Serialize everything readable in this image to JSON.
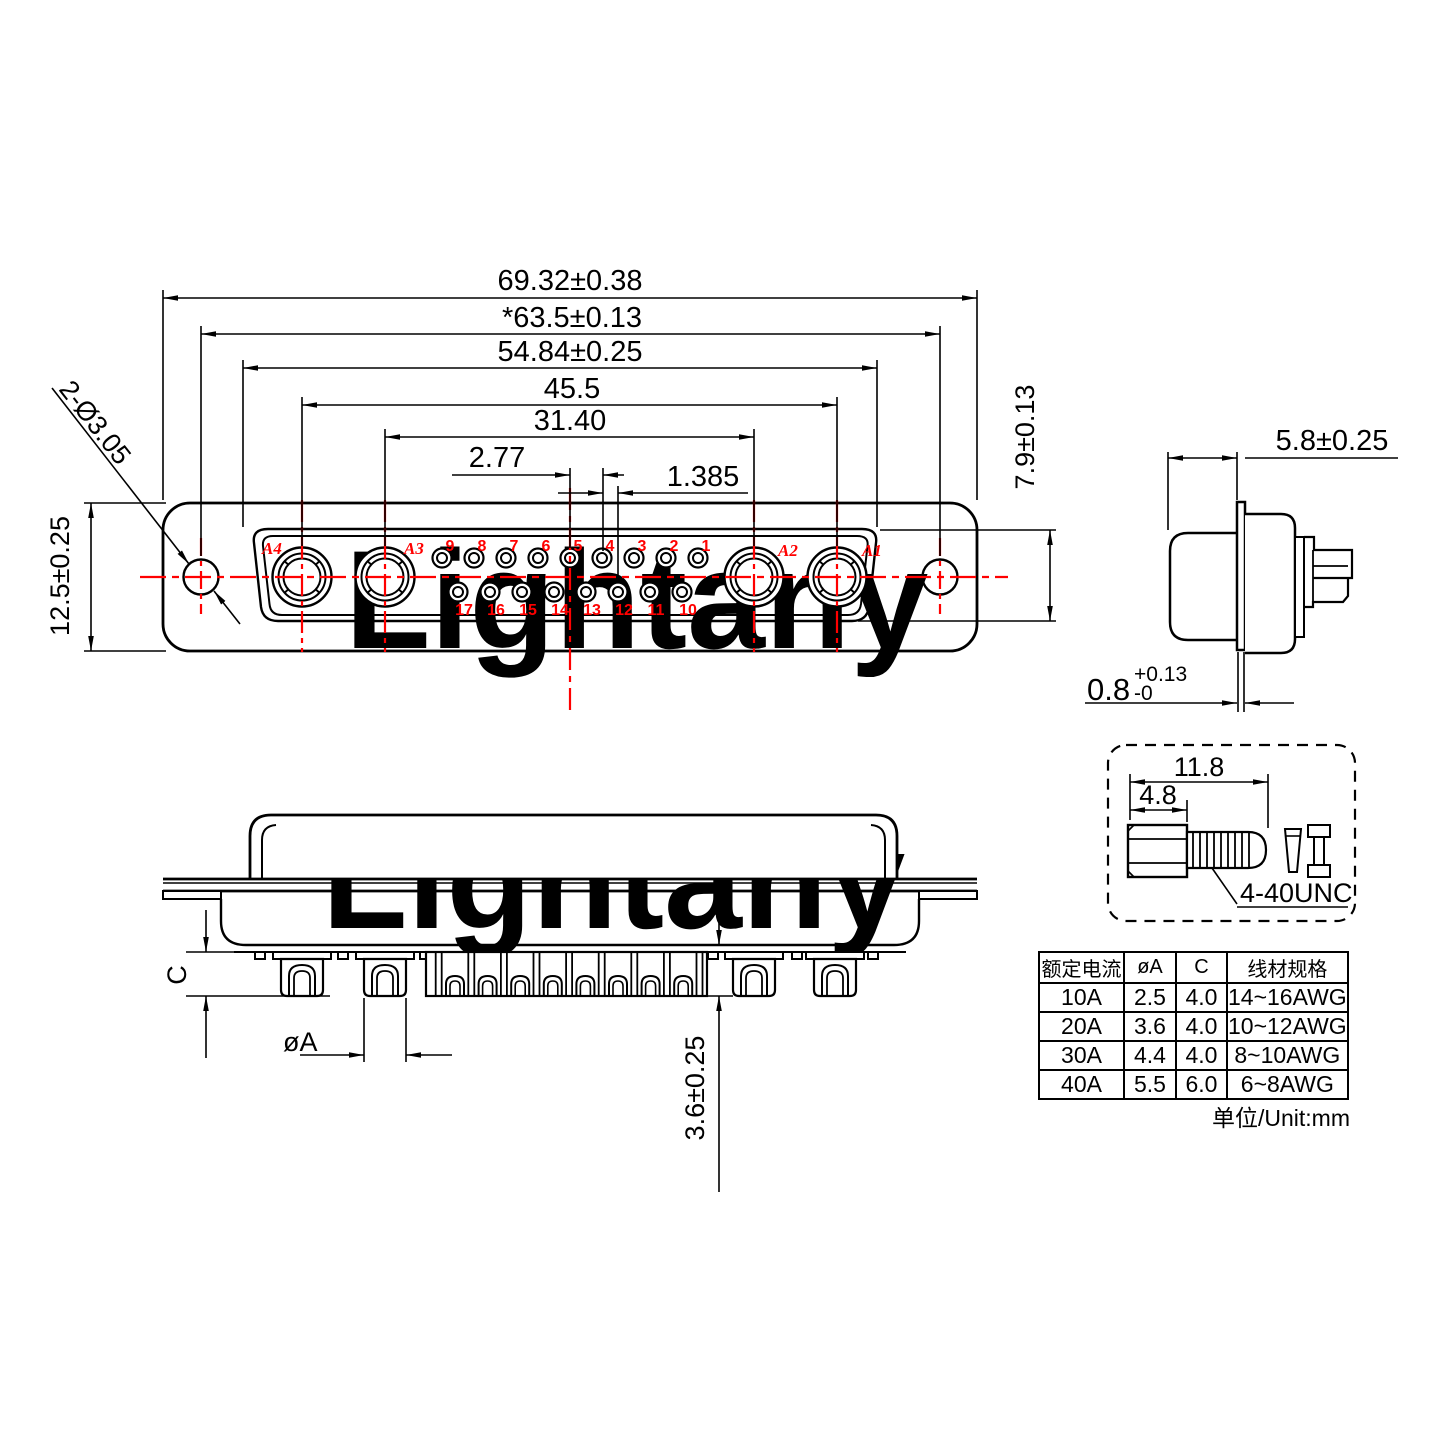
{
  "meta": {
    "drawing_type": "connector engineering drawing",
    "accent_red": "#ff0000",
    "watermark_pink": "#f8d2d2"
  },
  "watermark": {
    "text": "Lightany"
  },
  "front_view": {
    "dims": {
      "overall_width": "69.32±0.38",
      "mount_hole_spacing": "*63.5±0.13",
      "insert_width": "54.84±0.25",
      "outer_contact_spacing": "45.5",
      "inner_contact_spacing": "31.40",
      "pin_pitch": "2.77",
      "row_offset": "1.385",
      "flange_height": "12.5±0.25",
      "mount_hole_callout": "2-Ø3.05",
      "insert_height": "7.9±0.13"
    },
    "contact_labels": [
      "A4",
      "A3",
      "A2",
      "A1"
    ],
    "pin_numbers_top": [
      "9",
      "8",
      "7",
      "6",
      "5",
      "4",
      "3",
      "2",
      "1"
    ],
    "pin_numbers_bottom": [
      "17",
      "16",
      "15",
      "14",
      "13",
      "12",
      "11",
      "10"
    ]
  },
  "side_view_right": {
    "dims": {
      "front_depth": "5.8±0.25",
      "flange_thickness": "0.8",
      "flange_tol_plus": "+0.13",
      "flange_tol_minus": "-0"
    }
  },
  "side_view_bottom": {
    "dims": {
      "cup_depth": "C",
      "cup_diameter": "øA",
      "tail_length": "3.6±0.25"
    }
  },
  "screw_detail": {
    "dims": {
      "total_length": "11.8",
      "head_length": "4.8"
    },
    "thread_label": "4-40UNC"
  },
  "table": {
    "headers": [
      "额定电流",
      "øA",
      "C",
      "线材规格"
    ],
    "rows": [
      [
        "10A",
        "2.5",
        "4.0",
        "14~16AWG"
      ],
      [
        "20A",
        "3.6",
        "4.0",
        "10~12AWG"
      ],
      [
        "30A",
        "4.4",
        "4.0",
        "8~10AWG"
      ],
      [
        "40A",
        "5.5",
        "6.0",
        "6~8AWG"
      ]
    ],
    "unit_note": "单位/Unit:mm"
  }
}
